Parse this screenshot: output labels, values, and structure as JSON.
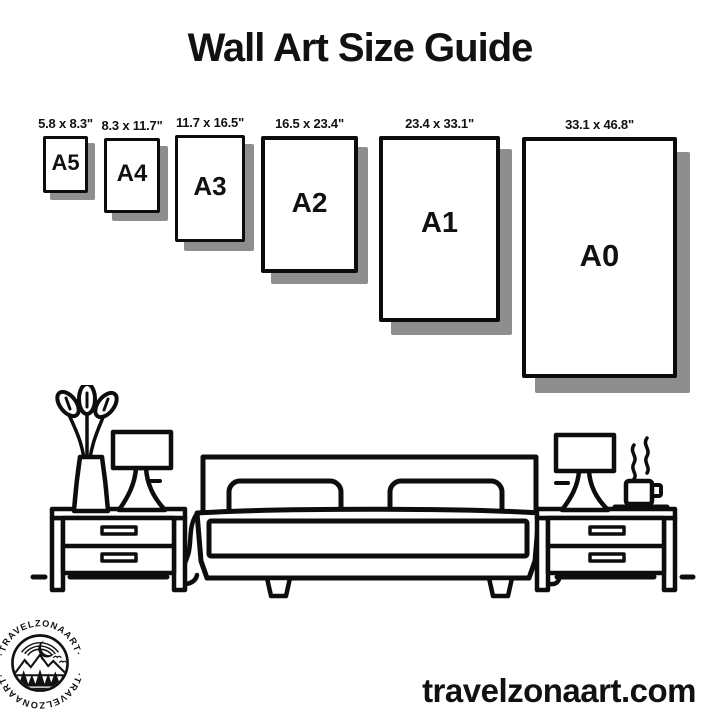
{
  "title": "Wall Art Size Guide",
  "website": "travelzonaart.com",
  "brand": {
    "name": "TRAVELZONAART",
    "ring_text": "·TRAVELZONAART·"
  },
  "colors": {
    "ink": "#111111",
    "frame_border": "#0c0c0c",
    "shadow": "#8e8e8e",
    "background": "#ffffff"
  },
  "sizes": [
    {
      "label": "A5",
      "dimensions": "5.8 x 8.3\""
    },
    {
      "label": "A4",
      "dimensions": "8.3 x 11.7\""
    },
    {
      "label": "A3",
      "dimensions": "11.7 x 16.5\""
    },
    {
      "label": "A2",
      "dimensions": "16.5 x 23.4\""
    },
    {
      "label": "A1",
      "dimensions": "23.4 x 33.1\""
    },
    {
      "label": "A0",
      "dimensions": "33.1 x 46.8\""
    }
  ],
  "illustration": {
    "icons": [
      "plant-vase-icon",
      "table-lamp-icon",
      "double-bed-icon",
      "nightstand-icon",
      "coffee-cup-icon",
      "mountain-badge-icon"
    ]
  }
}
